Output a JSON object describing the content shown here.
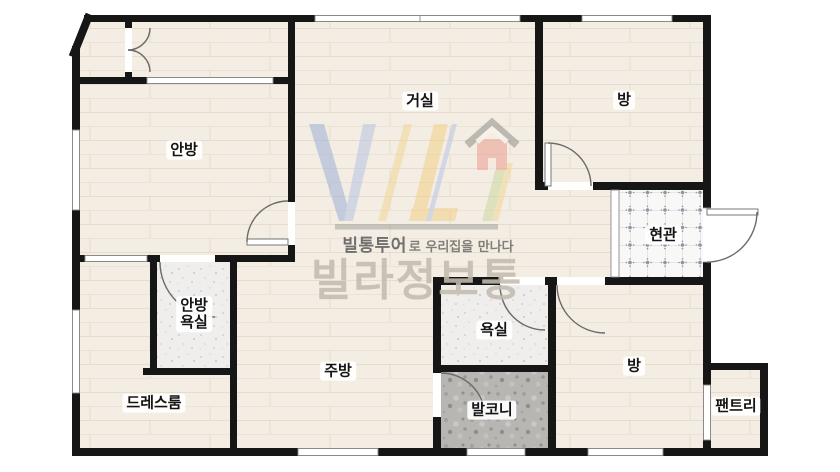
{
  "plan": {
    "rooms": {
      "master_bedroom": {
        "label": "안방"
      },
      "living_room": {
        "label": "거실"
      },
      "bedroom_top": {
        "label": "방"
      },
      "entrance": {
        "label": "현관"
      },
      "master_bathroom": {
        "label_line1": "안방",
        "label_line2": "욕실"
      },
      "dress_room": {
        "label": "드레스룸"
      },
      "kitchen": {
        "label": "주방"
      },
      "bathroom": {
        "label": "욕실"
      },
      "balcony": {
        "label": "발코니"
      },
      "bedroom_bottom": {
        "label": "방"
      },
      "pantry": {
        "label": "팬트리"
      }
    }
  },
  "watermark": {
    "tagline_bold": "빌통투어",
    "tagline_rest": "로 우리집을 만나다",
    "brand_name": "빌라정보통"
  },
  "colors": {
    "wall": "#161616",
    "wood_floor": "#f4ede3",
    "tile_floor": "#f8f8f6",
    "bathroom_floor": "#efeeec",
    "balcony_floor": "#b7b6b3",
    "logo_blue": "#a9bbdd",
    "logo_yellow": "#f1d089",
    "logo_green": "#cbd8a0",
    "logo_red": "#eb9e8e",
    "brand_text": "#c7bfb2"
  }
}
